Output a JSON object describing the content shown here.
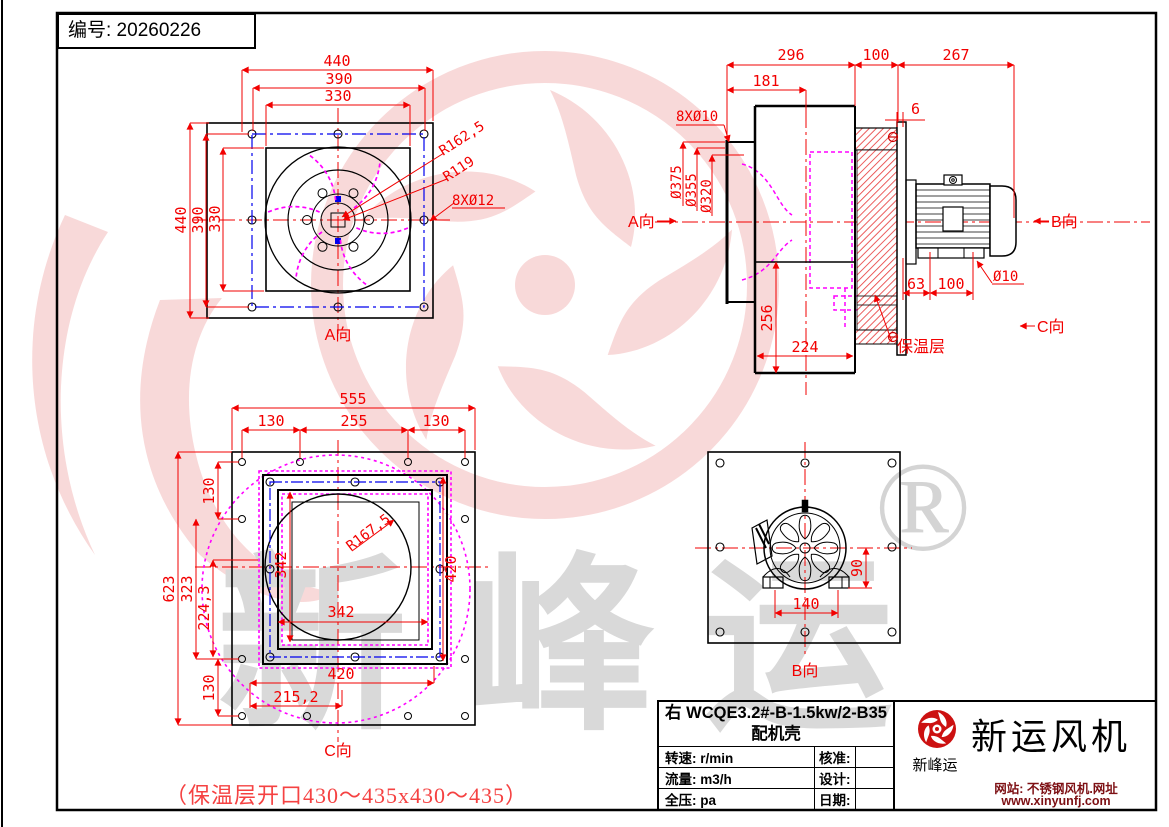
{
  "page": {
    "doc_number": "编号: 20260226",
    "bottom_note": "（保温层开口430～435x430～435）"
  },
  "watermark": {
    "char1": "新",
    "char2": "峰",
    "char3": "运",
    "registered": "®"
  },
  "view_a": {
    "label": "A向",
    "dim_top_440": "440",
    "dim_top_390": "390",
    "dim_top_330": "330",
    "dim_left_440": "440",
    "dim_left_390": "390",
    "dim_left_330": "330",
    "radius_outer": "R162,5",
    "radius_inner": "R119",
    "holes": "8XØ12"
  },
  "view_side": {
    "dim_296": "296",
    "dim_100": "100",
    "dim_267": "267",
    "dim_181": "181",
    "dim_6": "6",
    "holes": "8XØ10",
    "dia_375": "Ø375",
    "dia_355": "Ø355",
    "dia_320": "Ø320",
    "dim_256": "256",
    "dim_224": "224",
    "dim_63": "63",
    "dim_100b": "100",
    "dia_10": "Ø10",
    "insulation": "保温层",
    "view_a_arrow": "A向",
    "view_b_arrow": "B向",
    "view_c_arrow": "C向"
  },
  "view_c": {
    "label": "C向",
    "dim_555": "555",
    "dim_130a": "130",
    "dim_255": "255",
    "dim_130b": "130",
    "dim_130_top": "130",
    "dim_623": "623",
    "dim_323": "323",
    "dim_224_3": "224,3",
    "dim_130_bot": "130",
    "dim_342_v": "342",
    "dim_342_h": "342",
    "dim_420_v": "420",
    "dim_420_h": "420",
    "dim_215_2": "215,2",
    "radius": "R167,5"
  },
  "view_b": {
    "label": "B向",
    "dim_140": "140",
    "dim_90": "90"
  },
  "title_block": {
    "model": "右 WCQE3.2#-B-1.5kw/2-B35",
    "subtitle": "配机壳",
    "speed": "转速: r/min",
    "flow": "流量: m3/h",
    "pressure": "全压: pa",
    "approve": "核准:",
    "design": "设计:",
    "date": "日期:"
  },
  "company": {
    "logo_caption": "新峰运",
    "name": "新运风机",
    "site_line1": "网站: 不锈钢风机.网址",
    "site_line2": "www.xinyunfj.com"
  },
  "colors": {
    "line_black": "#000000",
    "dimension_red": "#f20000",
    "magenta": "#ff00ff",
    "bolt_blue": "#0000ee",
    "watermark_pink": "#f6caca",
    "watermark_gray": "#d9d9d9",
    "brand_red": "#cc1111",
    "website_red": "#7d1014",
    "note_red": "#f54242"
  }
}
